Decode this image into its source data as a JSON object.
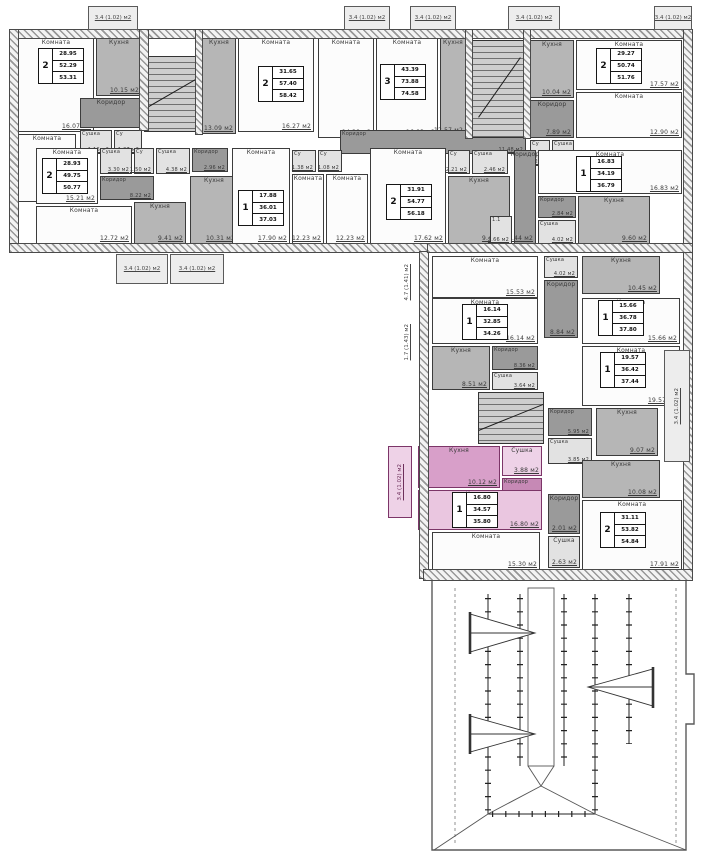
{
  "plan_title": "Поэтажный план",
  "legend": {
    "room": "Комната",
    "kitchen": "Кухня",
    "corridor": "Коридор",
    "drying": "Сушка",
    "wc": "Су",
    "unit": "1.1"
  },
  "rooms": [
    {
      "n": "living",
      "l": "Комната",
      "a": "16.07 м2",
      "x": 18,
      "y": 38,
      "w": 76,
      "h": 94,
      "f": "w"
    },
    {
      "n": "kitchen",
      "l": "Кухня",
      "a": "10.15 м2",
      "x": 96,
      "y": 38,
      "w": 46,
      "h": 58,
      "f": "g"
    },
    {
      "n": "corridor",
      "l": "Коридор",
      "a": "",
      "x": 80,
      "y": 98,
      "w": 62,
      "h": 30,
      "f": "d"
    },
    {
      "n": "drying",
      "l": "Сушка",
      "a": "1.16 м2",
      "x": 80,
      "y": 130,
      "w": 32,
      "h": 24,
      "f": "l"
    },
    {
      "n": "wc",
      "l": "Су",
      "a": "1.37 м2",
      "x": 114,
      "y": 130,
      "w": 28,
      "h": 24,
      "f": "l"
    },
    {
      "n": "living",
      "l": "Комната",
      "a": "12.26 м2",
      "x": 18,
      "y": 134,
      "w": 58,
      "h": 68,
      "f": "w"
    },
    {
      "n": "kitchen",
      "l": "Кухня",
      "a": "13.09 м2",
      "x": 202,
      "y": 38,
      "w": 34,
      "h": 96,
      "f": "g"
    },
    {
      "n": "living",
      "l": "Комната",
      "a": "16.27 м2",
      "x": 238,
      "y": 38,
      "w": 76,
      "h": 94,
      "f": "w"
    },
    {
      "n": "living",
      "l": "Комната",
      "a": "14.28 м2",
      "x": 318,
      "y": 38,
      "w": 56,
      "h": 100,
      "f": "w"
    },
    {
      "n": "living",
      "l": "Комната",
      "a": "16.83 м2",
      "x": 376,
      "y": 38,
      "w": 62,
      "h": 100,
      "f": "w"
    },
    {
      "n": "kitchen",
      "l": "Кухня",
      "a": "12.57 м2",
      "x": 440,
      "y": 38,
      "w": 26,
      "h": 98,
      "f": "g"
    },
    {
      "n": "kitchen",
      "l": "Кухня",
      "a": "10.04 м2",
      "x": 530,
      "y": 40,
      "w": 44,
      "h": 58,
      "f": "g"
    },
    {
      "n": "living",
      "l": "Комната",
      "a": "17.57 м2",
      "x": 576,
      "y": 40,
      "w": 106,
      "h": 50,
      "f": "w"
    },
    {
      "n": "living",
      "l": "Комната",
      "a": "12.90 м2",
      "x": 576,
      "y": 92,
      "w": 106,
      "h": 46,
      "f": "w"
    },
    {
      "n": "corridor",
      "l": "Коридор",
      "a": "7.89 м2",
      "x": 530,
      "y": 100,
      "w": 44,
      "h": 38,
      "f": "d"
    },
    {
      "n": "wc",
      "l": "Су",
      "a": "1.22 м2",
      "x": 530,
      "y": 140,
      "w": 20,
      "h": 26,
      "f": "l"
    },
    {
      "n": "drying",
      "l": "Сушка",
      "a": "3.06 м2",
      "x": 552,
      "y": 140,
      "w": 22,
      "h": 26,
      "f": "l"
    },
    {
      "n": "corridor",
      "l": "Коридор",
      "a": "11.48 м2",
      "x": 340,
      "y": 130,
      "w": 186,
      "h": 24,
      "f": "d"
    },
    {
      "n": "living",
      "l": "Комната",
      "a": "15.21 м2",
      "x": 36,
      "y": 148,
      "w": 62,
      "h": 56,
      "f": "w"
    },
    {
      "n": "drying",
      "l": "Сушка",
      "a": "3.30 м2",
      "x": 100,
      "y": 148,
      "w": 32,
      "h": 26,
      "f": "l"
    },
    {
      "n": "wc",
      "l": "Су",
      "a": "1.50 м2",
      "x": 134,
      "y": 148,
      "w": 20,
      "h": 26,
      "f": "l"
    },
    {
      "n": "corridor",
      "l": "Коридор",
      "a": "8.22 м2",
      "x": 100,
      "y": 176,
      "w": 54,
      "h": 24,
      "f": "d"
    },
    {
      "n": "living",
      "l": "Комната",
      "a": "12.72 м2",
      "x": 36,
      "y": 206,
      "w": 96,
      "h": 38,
      "f": "w"
    },
    {
      "n": "kitchen",
      "l": "Кухня",
      "a": "9.41 м2",
      "x": 134,
      "y": 202,
      "w": 52,
      "h": 42,
      "f": "g"
    },
    {
      "n": "drying",
      "l": "Сушка",
      "a": "4.38 м2",
      "x": 156,
      "y": 148,
      "w": 34,
      "h": 26,
      "f": "l"
    },
    {
      "n": "corridor",
      "l": "Коридор",
      "a": "2.96 м2",
      "x": 192,
      "y": 148,
      "w": 36,
      "h": 24,
      "f": "d"
    },
    {
      "n": "kitchen",
      "l": "Кухня",
      "a": "10.31 м2",
      "x": 190,
      "y": 176,
      "w": 48,
      "h": 68,
      "f": "g"
    },
    {
      "n": "living",
      "l": "Комната",
      "a": "17.90 м2",
      "x": 232,
      "y": 148,
      "w": 58,
      "h": 96,
      "f": "w"
    },
    {
      "n": "wc",
      "l": "Су",
      "a": "1.38 м2",
      "x": 292,
      "y": 150,
      "w": 24,
      "h": 22,
      "f": "l"
    },
    {
      "n": "wc",
      "l": "Су",
      "a": "1.08 м2",
      "x": 318,
      "y": 150,
      "w": 24,
      "h": 22,
      "f": "l"
    },
    {
      "n": "living",
      "l": "Комната",
      "a": "12.23 м2",
      "x": 292,
      "y": 174,
      "w": 32,
      "h": 70,
      "f": "w"
    },
    {
      "n": "living",
      "l": "Комната",
      "a": "12.23 м2",
      "x": 326,
      "y": 174,
      "w": 42,
      "h": 70,
      "f": "w"
    },
    {
      "n": "living",
      "l": "Комната",
      "a": "17.62 м2",
      "x": 370,
      "y": 148,
      "w": 76,
      "h": 96,
      "f": "w"
    },
    {
      "n": "wc",
      "l": "Су",
      "a": "2.21 м2",
      "x": 448,
      "y": 150,
      "w": 22,
      "h": 24,
      "f": "l"
    },
    {
      "n": "drying",
      "l": "Сушка",
      "a": "2.46 м2",
      "x": 472,
      "y": 150,
      "w": 36,
      "h": 24,
      "f": "l"
    },
    {
      "n": "kitchen",
      "l": "Кухня",
      "a": "9.48 м2",
      "x": 448,
      "y": 176,
      "w": 62,
      "h": 68,
      "f": "g"
    },
    {
      "n": "corridor",
      "l": "Коридор",
      "a": "5.44 м2",
      "x": 514,
      "y": 150,
      "w": 22,
      "h": 94,
      "f": "d"
    },
    {
      "n": "unit",
      "l": "1.1",
      "a": "2.66 м2",
      "x": 490,
      "y": 216,
      "w": 22,
      "h": 28,
      "f": "l"
    },
    {
      "n": "living",
      "l": "Комната",
      "a": "16.83 м2",
      "x": 538,
      "y": 150,
      "w": 144,
      "h": 44,
      "f": "w"
    },
    {
      "n": "corridor",
      "l": "Коридор",
      "a": "2.84 м2",
      "x": 538,
      "y": 196,
      "w": 38,
      "h": 22,
      "f": "d"
    },
    {
      "n": "drying",
      "l": "Сушка",
      "a": "4.02 м2",
      "x": 538,
      "y": 220,
      "w": 38,
      "h": 24,
      "f": "l"
    },
    {
      "n": "kitchen",
      "l": "Кухня",
      "a": "9.60 м2",
      "x": 578,
      "y": 196,
      "w": 72,
      "h": 48,
      "f": "g"
    },
    {
      "n": "living",
      "l": "Комната",
      "a": "15.53 м2",
      "x": 432,
      "y": 256,
      "w": 106,
      "h": 42,
      "f": "w"
    },
    {
      "n": "drying",
      "l": "Сушка",
      "a": "4.02 м2",
      "x": 544,
      "y": 256,
      "w": 34,
      "h": 22,
      "f": "l"
    },
    {
      "n": "kitchen",
      "l": "Кухня",
      "a": "10.45 м2",
      "x": 582,
      "y": 256,
      "w": 78,
      "h": 38,
      "f": "g"
    },
    {
      "n": "corridor",
      "l": "Коридор",
      "a": "8.84 м2",
      "x": 544,
      "y": 280,
      "w": 34,
      "h": 58,
      "f": "d"
    },
    {
      "n": "living",
      "l": "Комната",
      "a": "15.66 м2",
      "x": 582,
      "y": 298,
      "w": 98,
      "h": 46,
      "f": "w"
    },
    {
      "n": "living",
      "l": "Комната",
      "a": "16.14 м2",
      "x": 432,
      "y": 298,
      "w": 106,
      "h": 46,
      "f": "w"
    },
    {
      "n": "kitchen",
      "l": "Кухня",
      "a": "8.51 м2",
      "x": 432,
      "y": 346,
      "w": 58,
      "h": 44,
      "f": "g"
    },
    {
      "n": "corridor",
      "l": "Коридор",
      "a": "8.36 м2",
      "x": 492,
      "y": 346,
      "w": 46,
      "h": 24,
      "f": "d"
    },
    {
      "n": "drying",
      "l": "Сушка",
      "a": "3.64 м2",
      "x": 492,
      "y": 372,
      "w": 46,
      "h": 18,
      "f": "l"
    },
    {
      "n": "living",
      "l": "Комната",
      "a": "19.57 м2",
      "x": 582,
      "y": 346,
      "w": 98,
      "h": 60,
      "f": "w"
    },
    {
      "n": "corridor",
      "l": "Коридор",
      "a": "5.95 м2",
      "x": 548,
      "y": 408,
      "w": 44,
      "h": 28,
      "f": "d"
    },
    {
      "n": "drying",
      "l": "Сушка",
      "a": "3.85 м2",
      "x": 548,
      "y": 438,
      "w": 44,
      "h": 26,
      "f": "l"
    },
    {
      "n": "kitchen",
      "l": "Кухня",
      "a": "9.07 м2",
      "x": 596,
      "y": 408,
      "w": 62,
      "h": 48,
      "f": "g"
    },
    {
      "n": "kitchen",
      "l": "Кухня",
      "a": "10.08 м2",
      "x": 582,
      "y": 460,
      "w": 78,
      "h": 38,
      "f": "g"
    },
    {
      "n": "living",
      "l": "Комната",
      "a": "17.91 м2",
      "x": 582,
      "y": 500,
      "w": 100,
      "h": 70,
      "f": "w"
    },
    {
      "n": "corridor",
      "l": "Коридор",
      "a": "2.01 м2",
      "x": 548,
      "y": 494,
      "w": 32,
      "h": 40,
      "f": "d"
    },
    {
      "n": "drying",
      "l": "Сушка",
      "a": "2.63 м2",
      "x": 548,
      "y": 536,
      "w": 32,
      "h": 32,
      "f": "l"
    },
    {
      "n": "living",
      "l": "Комната",
      "a": "15.30 м2",
      "x": 432,
      "y": 532,
      "w": 108,
      "h": 38,
      "f": "w"
    },
    {
      "n": "kitchen",
      "l": "Кухня",
      "a": "10.12 м2",
      "x": 418,
      "y": 446,
      "w": 82,
      "h": 42,
      "f": "pM",
      "sel": true
    },
    {
      "n": "drying",
      "l": "Сушка",
      "a": "3.88 м2",
      "x": 502,
      "y": 446,
      "w": 40,
      "h": 30,
      "f": "pL",
      "sel": true
    },
    {
      "n": "corridor",
      "l": "Коридор",
      "a": "3.52 м2",
      "x": 502,
      "y": 478,
      "w": 40,
      "h": 20,
      "f": "pD",
      "sel": true
    },
    {
      "n": "living",
      "l": "Комната",
      "a": "16.80 м2",
      "x": 418,
      "y": 490,
      "w": 124,
      "h": 40,
      "f": "pR",
      "sel": true
    }
  ],
  "apartments": [
    {
      "num": "2",
      "values": [
        "28.95",
        "52.29",
        "53.31"
      ],
      "x": 38,
      "y": 48
    },
    {
      "num": "2",
      "values": [
        "31.65",
        "57.40",
        "58.42"
      ],
      "x": 258,
      "y": 66
    },
    {
      "num": "3",
      "values": [
        "43.39",
        "73.88",
        "74.58"
      ],
      "x": 380,
      "y": 64
    },
    {
      "num": "2",
      "values": [
        "29.27",
        "50.74",
        "51.76"
      ],
      "x": 596,
      "y": 48
    },
    {
      "num": "2",
      "values": [
        "28.93",
        "49.75",
        "50.77"
      ],
      "x": 42,
      "y": 158
    },
    {
      "num": "1",
      "values": [
        "17.88",
        "36.01",
        "37.03"
      ],
      "x": 238,
      "y": 190
    },
    {
      "num": "2",
      "values": [
        "31.91",
        "54.77",
        "56.18"
      ],
      "x": 386,
      "y": 184
    },
    {
      "num": "1",
      "values": [
        "16.83",
        "34.19",
        "36.79"
      ],
      "x": 576,
      "y": 156
    },
    {
      "num": "1",
      "values": [
        "16.14",
        "32.85",
        "34.26"
      ],
      "x": 462,
      "y": 304
    },
    {
      "num": "1",
      "values": [
        "15.66",
        "36.78",
        "37.80"
      ],
      "x": 598,
      "y": 300
    },
    {
      "num": "1",
      "values": [
        "19.57",
        "36.42",
        "37.44"
      ],
      "x": 600,
      "y": 352
    },
    {
      "num": "1",
      "values": [
        "16.80",
        "34.57",
        "35.80"
      ],
      "x": 452,
      "y": 492,
      "sel": true
    },
    {
      "num": "2",
      "values": [
        "31.11",
        "53.82",
        "54.84"
      ],
      "x": 600,
      "y": 512
    }
  ],
  "balconies": [
    {
      "x": 88,
      "y": 6,
      "w": 50,
      "h": 24,
      "label": "3.4 (1.02) м2"
    },
    {
      "x": 344,
      "y": 6,
      "w": 46,
      "h": 24,
      "label": "3.4 (1.02) м2"
    },
    {
      "x": 410,
      "y": 6,
      "w": 46,
      "h": 24,
      "label": "3.4 (1.02) м2"
    },
    {
      "x": 508,
      "y": 6,
      "w": 52,
      "h": 24,
      "label": "3.4 (1.02) м2"
    },
    {
      "x": 654,
      "y": 6,
      "w": 38,
      "h": 24,
      "label": "3.4 (1.02) м2"
    },
    {
      "x": 116,
      "y": 254,
      "w": 52,
      "h": 30,
      "label": "3.4 (1.02) м2"
    },
    {
      "x": 170,
      "y": 254,
      "w": 54,
      "h": 30,
      "label": "3.4 (1.02) м2"
    },
    {
      "x": 664,
      "y": 350,
      "w": 26,
      "h": 112,
      "label": "3.4 (1.02) м2",
      "vertical": true
    },
    {
      "x": 388,
      "y": 446,
      "w": 24,
      "h": 72,
      "label": "3.4 (1.02) м2",
      "vertical": true,
      "pink": true
    }
  ],
  "vlabels": [
    {
      "x": 404,
      "y": 264,
      "text": "4.7 (1.41) м2"
    },
    {
      "x": 404,
      "y": 324,
      "text": "1.7 (1.43) м2"
    }
  ],
  "walls": [
    [
      10,
      30,
      682,
      8
    ],
    [
      10,
      30,
      8,
      222
    ],
    [
      10,
      244,
      418,
      8
    ],
    [
      684,
      30,
      8,
      548
    ],
    [
      420,
      252,
      8,
      326
    ],
    [
      424,
      570,
      268,
      10
    ],
    [
      428,
      244,
      264,
      8
    ],
    [
      140,
      30,
      8,
      100
    ],
    [
      196,
      30,
      6,
      104
    ],
    [
      466,
      30,
      6,
      108
    ],
    [
      524,
      30,
      6,
      108
    ]
  ],
  "stairs": [
    {
      "x": 144,
      "y": 56,
      "w": 52,
      "h": 74,
      "deg": -30
    },
    {
      "x": 472,
      "y": 40,
      "w": 52,
      "h": 96,
      "deg": -55
    },
    {
      "x": 478,
      "y": 392,
      "w": 64,
      "h": 50,
      "deg": -22
    }
  ]
}
